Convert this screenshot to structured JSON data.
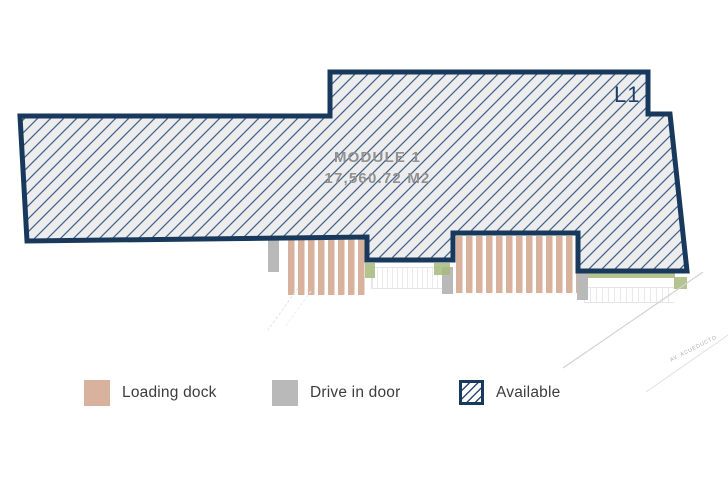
{
  "module": {
    "name": "MODULE 1",
    "area": "17,560.72 M2",
    "level": "L1"
  },
  "street": {
    "name": "AV. ACUEDUCTO"
  },
  "legend": {
    "items": [
      {
        "id": "loading-dock",
        "label": "Loading dock",
        "color": "#d8b29c"
      },
      {
        "id": "drive-in-door",
        "label": "Drive in door",
        "color": "#b9b9b9"
      },
      {
        "id": "available",
        "label": "Available",
        "color": "#18395c"
      }
    ]
  },
  "colors": {
    "outline_navy": "#18395c",
    "hatch_line": "#44648e",
    "hatch_fill": "#ededed",
    "loading_dock_tan": "#d8b29c",
    "drive_in_gray": "#b9b9b9",
    "landscape_green": "#a7ba7e",
    "module_text_gray": "#919191"
  }
}
